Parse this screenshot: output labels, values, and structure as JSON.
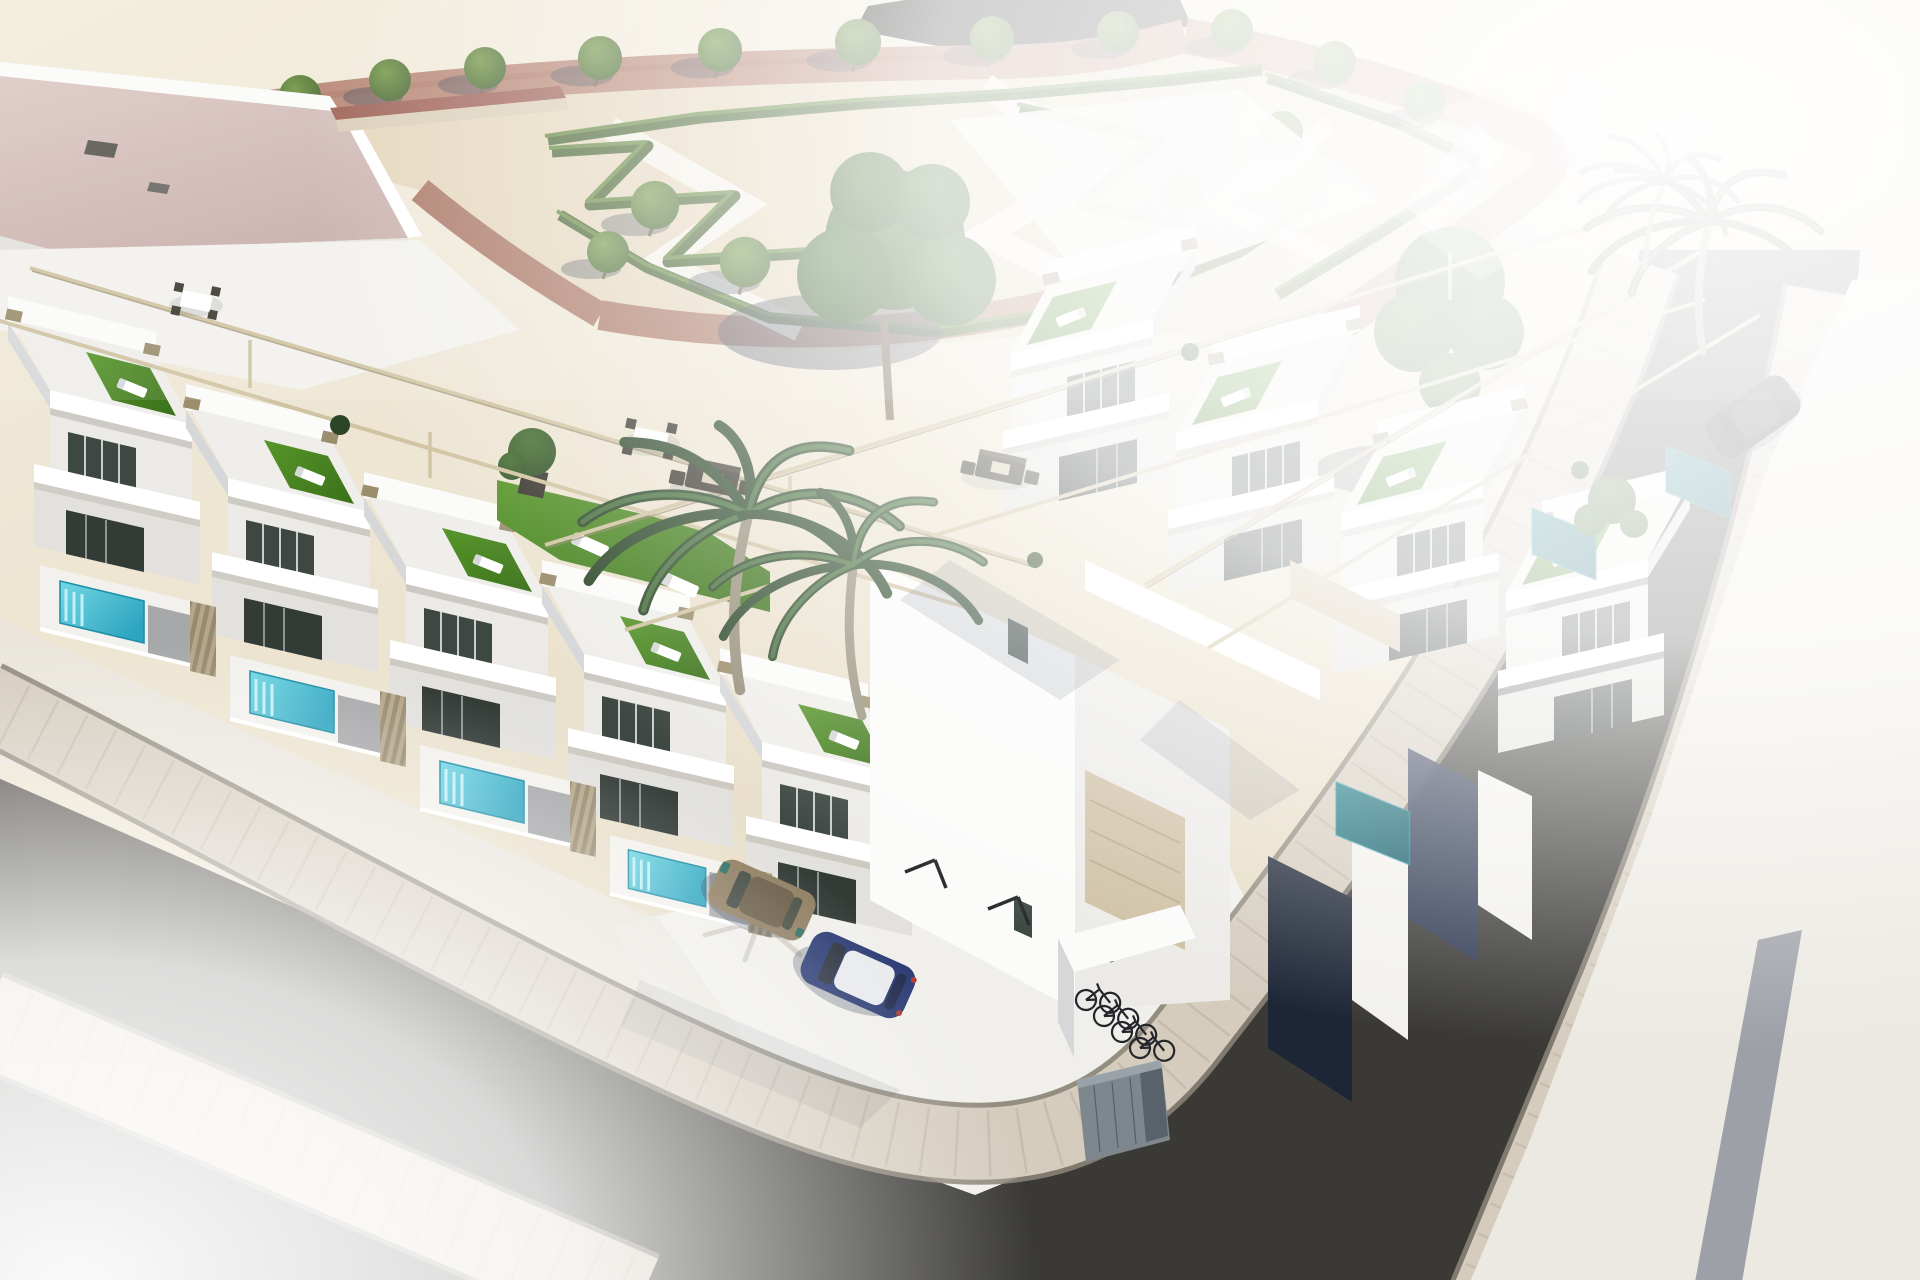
{
  "scene": {
    "description": "Aerial 3D architectural rendering of a modern white residential corner development: two rows of flat-roofed townhouses with rooftop solariums (artificial turf, sun loungers, rattan lounge and dining sets, slim pergola beams), small private plunge pools behind slatted beige fences, a landscaped public garden with zig-zag hedges, gravel, pink walkways and rows of trees, an existing pink-roofed building at the upper left, palm trees, a white off-street parking court with two parked cars and a bicycle shelter, and two dark asphalt streets with paved sidewalks meeting at a rounded corner.",
    "style": "computer generated render, overexposed white highlights at top-right and bottom-left corners",
    "view": "high three-quarter aerial view",
    "time_of_day": "bright midday sun, shadows falling to the lower left"
  },
  "inventory": {
    "townhouse_units_left_row": 5,
    "townhouse_units_right_row": 4,
    "rooftop_solariums_with_turf": 9,
    "sun_loungers": 12,
    "rattan_lounge_sets": 2,
    "rooftop_dining_sets": 2,
    "private_pools_sunlit": 4,
    "private_pools_shaded": 3,
    "pergola_beams": 6,
    "palm_trees": 4,
    "park_trees": 16,
    "large_trees": 2,
    "hedge_rows": 6,
    "existing_building": "large flat pink/mauve roof with rooftop AC units",
    "cars": [
      {
        "color_name": "bronze-brown",
        "location": "parking court"
      },
      {
        "color_name": "dark blue with white roof",
        "location": "parking court"
      },
      {
        "color_name": "black",
        "location": "right street"
      }
    ],
    "parking_bay_markers": 3,
    "bicycles": 4,
    "storage_cabinets": 2,
    "streets": 2,
    "sidewalk_type": "light paver blocks with visible grid",
    "corner": "rounded curb corner at bottom center"
  },
  "colors": {
    "bgTop": "#f3ecdc",
    "bgBottom": "#e3d8c0",
    "parkSand": "#e0d3b6",
    "white": "#ffffff",
    "parapet": "#fbfbfa",
    "offwhite": "#f2f1ed",
    "deck": "#efeeea",
    "wallLight": "#ebeae7",
    "wallMid": "#e2e1de",
    "wallShade": "#d6d7d9",
    "wallDark": "#b7b8bb",
    "glass": "#3e4843",
    "glassDark": "#333b37",
    "mullion": "#eef0ee",
    "windowDark": "#2f3339",
    "roofPinkLight": "#decac5",
    "roofPinkDark": "#c8aeaa",
    "pathPink": "#b5806e",
    "pathPinkDark": "#a5705c",
    "walkWhite": "#f4f0e7",
    "hedgeDark": "#3e5c26",
    "hedgeLight": "#5c8135",
    "treeLight": "#6f9440",
    "treeDark": "#3a5c27",
    "bigTree1": "#466f30",
    "bigTree2": "#2f5026",
    "shadow": "#333c4e",
    "turfLight": "#58962a",
    "turfDark": "#3c741b",
    "pergola": "#d0c3a1",
    "pergolaDark": "#95886a",
    "cap": "#9b8e6d",
    "poolLight": "#74d8e4",
    "poolDark": "#2da4c0",
    "poolEdge": "#1f8fa8",
    "poolStep": "#c3eff6",
    "poolShaded": "#177683",
    "poolShadedDark": "#0e5967",
    "fenceLight": "#b4a68a",
    "fenceDark": "#978a6f",
    "patio": "#9a9b9d",
    "asphaltLight": "#53514b",
    "asphaltDark": "#3a3936",
    "paver": "#d5ccbe",
    "paverTick": "#bbb09e",
    "curb": "#8a8375",
    "concrete": "#f0efeb",
    "pavement": "#ece9e2",
    "grayBand": "#8f939c",
    "navy": "#1d2636",
    "navyLight": "#2e3a55",
    "carBronze": "#8f7e62",
    "carBronzeDark": "#6b5e49",
    "carBlue": "#2c3c74",
    "carRoof": "#e9eaee",
    "carDark": "#17191e",
    "bike": "#24252a",
    "cabinet": "#7e868e",
    "cabinetLight": "#9aa2a9",
    "cabinetSlot": "#59616a",
    "marker": "#26272a",
    "trunk": "#99917d",
    "trunkDark": "#6e5f4a",
    "palmDark": "#2e4a2c",
    "palmLight": "#48703e",
    "bush": "#2c4527",
    "terracotta": "#9a5b4e",
    "sandWall": "#d8cbb4",
    "tailRed": "#b33a2e",
    "glint": "#2e6f63",
    "shadeSoft": "#bcb7ac",
    "sofa": "#3a382f",
    "sofaLight": "#4a473d",
    "cushion": "#d8cdb4"
  }
}
